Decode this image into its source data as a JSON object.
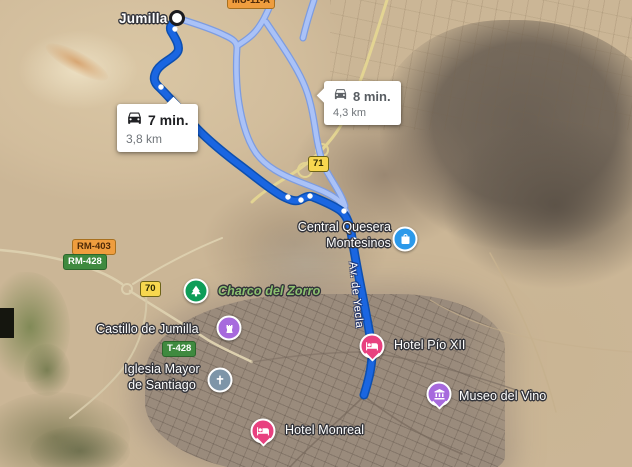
{
  "map": {
    "town_label": "Jumilla",
    "street_label": "Av. de Yecla",
    "route_options": {
      "primary": {
        "duration": "7 min.",
        "distance": "3,8 km"
      },
      "alternate": {
        "duration": "8 min.",
        "distance": "4,3 km"
      }
    },
    "road_shields": {
      "mu_11_a": "MU-11-A",
      "a_71": "71",
      "rm_403": "RM-403",
      "rm_428": "RM-428",
      "a_70": "70",
      "t_428": "T-428"
    },
    "pois": {
      "central_quesera": {
        "line1": "Central Quesera",
        "line2": "Montesinos",
        "icon": "shopping-bag-icon"
      },
      "charco_del_zorro": {
        "label": "Charco del Zorro",
        "icon": "tree-icon"
      },
      "castillo_de_jumilla": {
        "label": "Castillo de Jumilla",
        "icon": "castle-icon"
      },
      "iglesia_mayor": {
        "line1": "Iglesia Mayor",
        "line2": "de Santiago",
        "icon": "church-cross-icon"
      },
      "hotel_pio_xii": {
        "label": "Hotel Pío XII",
        "icon": "bed-icon"
      },
      "museo_del_vino": {
        "label": "Museo del Vino",
        "icon": "museum-icon"
      },
      "hotel_monreal": {
        "label": "Hotel Monreal",
        "icon": "bed-icon"
      }
    },
    "colors": {
      "primary_route": "#1a66e1",
      "primary_route_casing": "#0c4fb0",
      "alternate_route": "#aac2f7",
      "alternate_route_casing": "#7d9ce0",
      "hotel_pin": "#e8417f",
      "attraction_icon": "#a76add",
      "park_icon": "#0e9d58",
      "shopping_icon": "#2b99ea",
      "church_icon": "#7e95a8",
      "park_label": "#8cc170"
    }
  }
}
